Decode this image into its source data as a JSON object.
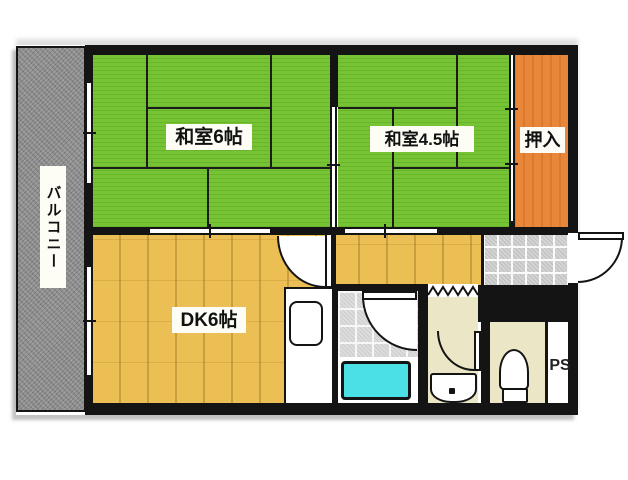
{
  "title": "Japanese apartment floor plan",
  "rooms": {
    "balcony": {
      "label": "バルコニー"
    },
    "japanese_room_6": {
      "label": "和室6帖"
    },
    "japanese_room_45": {
      "label": "和室4.5帖"
    },
    "closet": {
      "label": "押入"
    },
    "dining_kitchen": {
      "label": "DK6帖"
    },
    "pipe_space": {
      "label": "PS"
    }
  },
  "colors": {
    "wall": "#141414",
    "tatami_green": "#76c434",
    "tatami_line": "#1c1c1c",
    "wood_floor": "#ecbf55",
    "closet_orange": "#e8873a",
    "balcony_gray": "#8e8e8e",
    "cream": "#eae6c6",
    "tile_gray": "#dddddd",
    "genkan_tile": "#d4d4d4",
    "bathtub_cyan": "#4bdfe6",
    "label_bg": "#fdfdf5",
    "text": "#111111"
  }
}
